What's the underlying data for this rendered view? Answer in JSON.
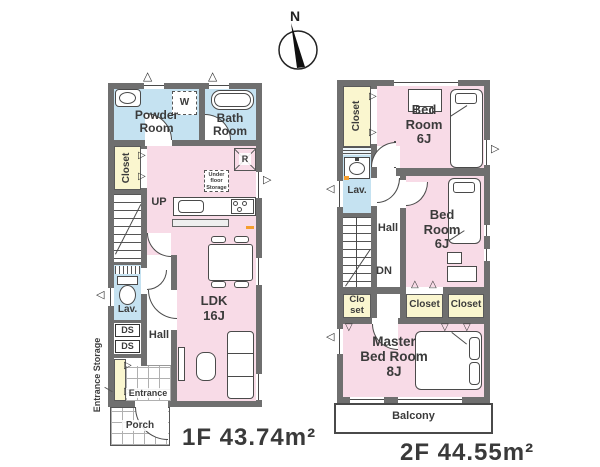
{
  "compass": {
    "north_label": "N"
  },
  "colors": {
    "room_pink": "#f8dbe7",
    "room_blue": "#c5e2f1",
    "closet_yellow": "#faf6cf",
    "wall_gray": "#6f6f6f",
    "accent_orange": "#f59e2e",
    "text": "#3b3b3b"
  },
  "symbols": {
    "fold_door_right": "▷",
    "fold_door_left": "◁",
    "fold_door_up": "△",
    "fold_door_down": "▽"
  },
  "floor1": {
    "title": "1F 43.74m²",
    "labels": {
      "powder_room": "Powder\nRoom",
      "bath_room": "Bath\nRoom",
      "washer": "W",
      "closet": "Closet",
      "up": "UP",
      "refrigerator": "R",
      "under_floor_storage": "Under\nfloor\nStorage",
      "ldk": "LDK\n16J",
      "lav": "Lav.",
      "ds_upper": "DS",
      "ds_lower": "DS",
      "hall": "Hall",
      "entrance_storage": "Entrance Storage",
      "entrance": "Entrance",
      "porch": "Porch"
    }
  },
  "floor2": {
    "title": "2F 44.55m²",
    "labels": {
      "closet_north": "Closet",
      "bedroom_north": "Bed\nRoom\n6J",
      "lav": "Lav.",
      "hall": "Hall",
      "dn": "DN",
      "bedroom_middle": "Bed\nRoom\n6J",
      "closet_stair": "Clo\nset",
      "closet_inner": "Closet",
      "closet_outer": "Closet",
      "master_bedroom": "Master\nBed Room\n8J",
      "balcony": "Balcony"
    }
  }
}
